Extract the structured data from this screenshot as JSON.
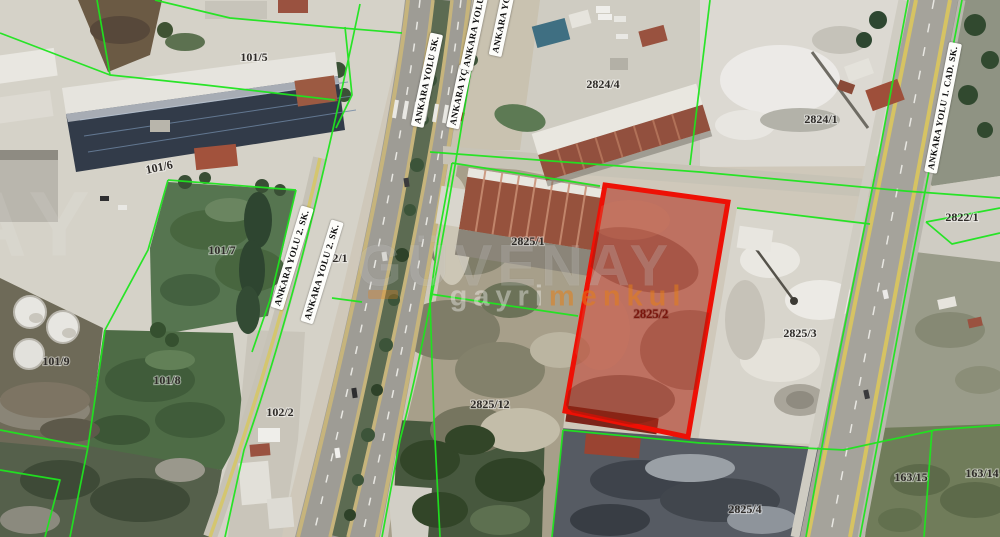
{
  "map": {
    "kind": "satellite-cadastral-view",
    "highlight_parcel": {
      "label": "2825/2",
      "fill": "#b02a18",
      "stroke": "#ee1005"
    },
    "colors": {
      "boundary_green": "#1fe51f",
      "label_text": "#2e2b28",
      "highlight_label": "#7a150c",
      "road_stripe_yellow": "#d2bf6d",
      "watermark_orange": "#e47e18"
    },
    "parcels": [
      {
        "label": "101/5"
      },
      {
        "label": "101/6"
      },
      {
        "label": "101/7"
      },
      {
        "label": "101/9"
      },
      {
        "label": "101/8"
      },
      {
        "label": "102/1"
      },
      {
        "label": "102/2"
      },
      {
        "label": "2824/4"
      },
      {
        "label": "2824/1"
      },
      {
        "label": "2822/1"
      },
      {
        "label": "2825/1"
      },
      {
        "label": "2825/3"
      },
      {
        "label": "2825/12"
      },
      {
        "label": "2825/4"
      },
      {
        "label": "163/15"
      },
      {
        "label": "163/14"
      }
    ],
    "streets": [
      {
        "name": "ANKARA YOLU SK."
      },
      {
        "name": "ANKARA YÇ"
      },
      {
        "name": "ANKARA YOLU"
      },
      {
        "name": "ANKARA YOLU"
      },
      {
        "name": "ANKARA YOLU 2. SK."
      },
      {
        "name": "ANKARA YOLU 2. SK."
      },
      {
        "name": "ANKARA YOLU 1. CAD. SK."
      }
    ],
    "watermark": {
      "brand": "GÜVENAY",
      "subtitle_left": "gayri",
      "subtitle_right": "menkul",
      "fragment": "AY"
    }
  }
}
